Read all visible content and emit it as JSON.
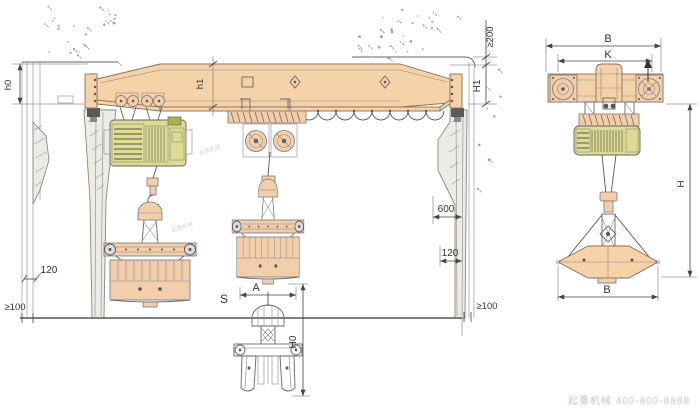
{
  "page": {
    "type": "engineering-drawing",
    "subject": "Single girder crane with electric hoist and grab bucket — front elevation and side elevation",
    "background": "#ffffff"
  },
  "colors": {
    "steel_fill": "#f6d2a8",
    "steel_stroke": "#8a7057",
    "hoist_fill": "#dedc92",
    "hoist_accent": "#a8b446",
    "leg_fill": "#ecebe6",
    "dimension_line": "#444444",
    "text": "#333333",
    "ground": "#555555",
    "concrete_dots": "#8b8b8b",
    "watermark": "#9a9a9a"
  },
  "labels": {
    "front": {
      "hoist_headroom": "h0",
      "girder_depth": "h1",
      "ceiling_clearance": "≥200",
      "crane_height": "H1",
      "hook_approach": "600",
      "right_offset": "120",
      "left_offset": "120",
      "left_wall_clearance": "≥100",
      "right_wall_clearance": "≥100",
      "span": "S",
      "grab_width": "A",
      "below_floor_lift": "H0"
    },
    "side": {
      "overall_width": "B",
      "wheel_base": "K",
      "height": "H",
      "grab_span": "B"
    }
  },
  "watermark": {
    "company": "起重机械",
    "phone": "400-800-8888",
    "tiny": "起重机械"
  }
}
